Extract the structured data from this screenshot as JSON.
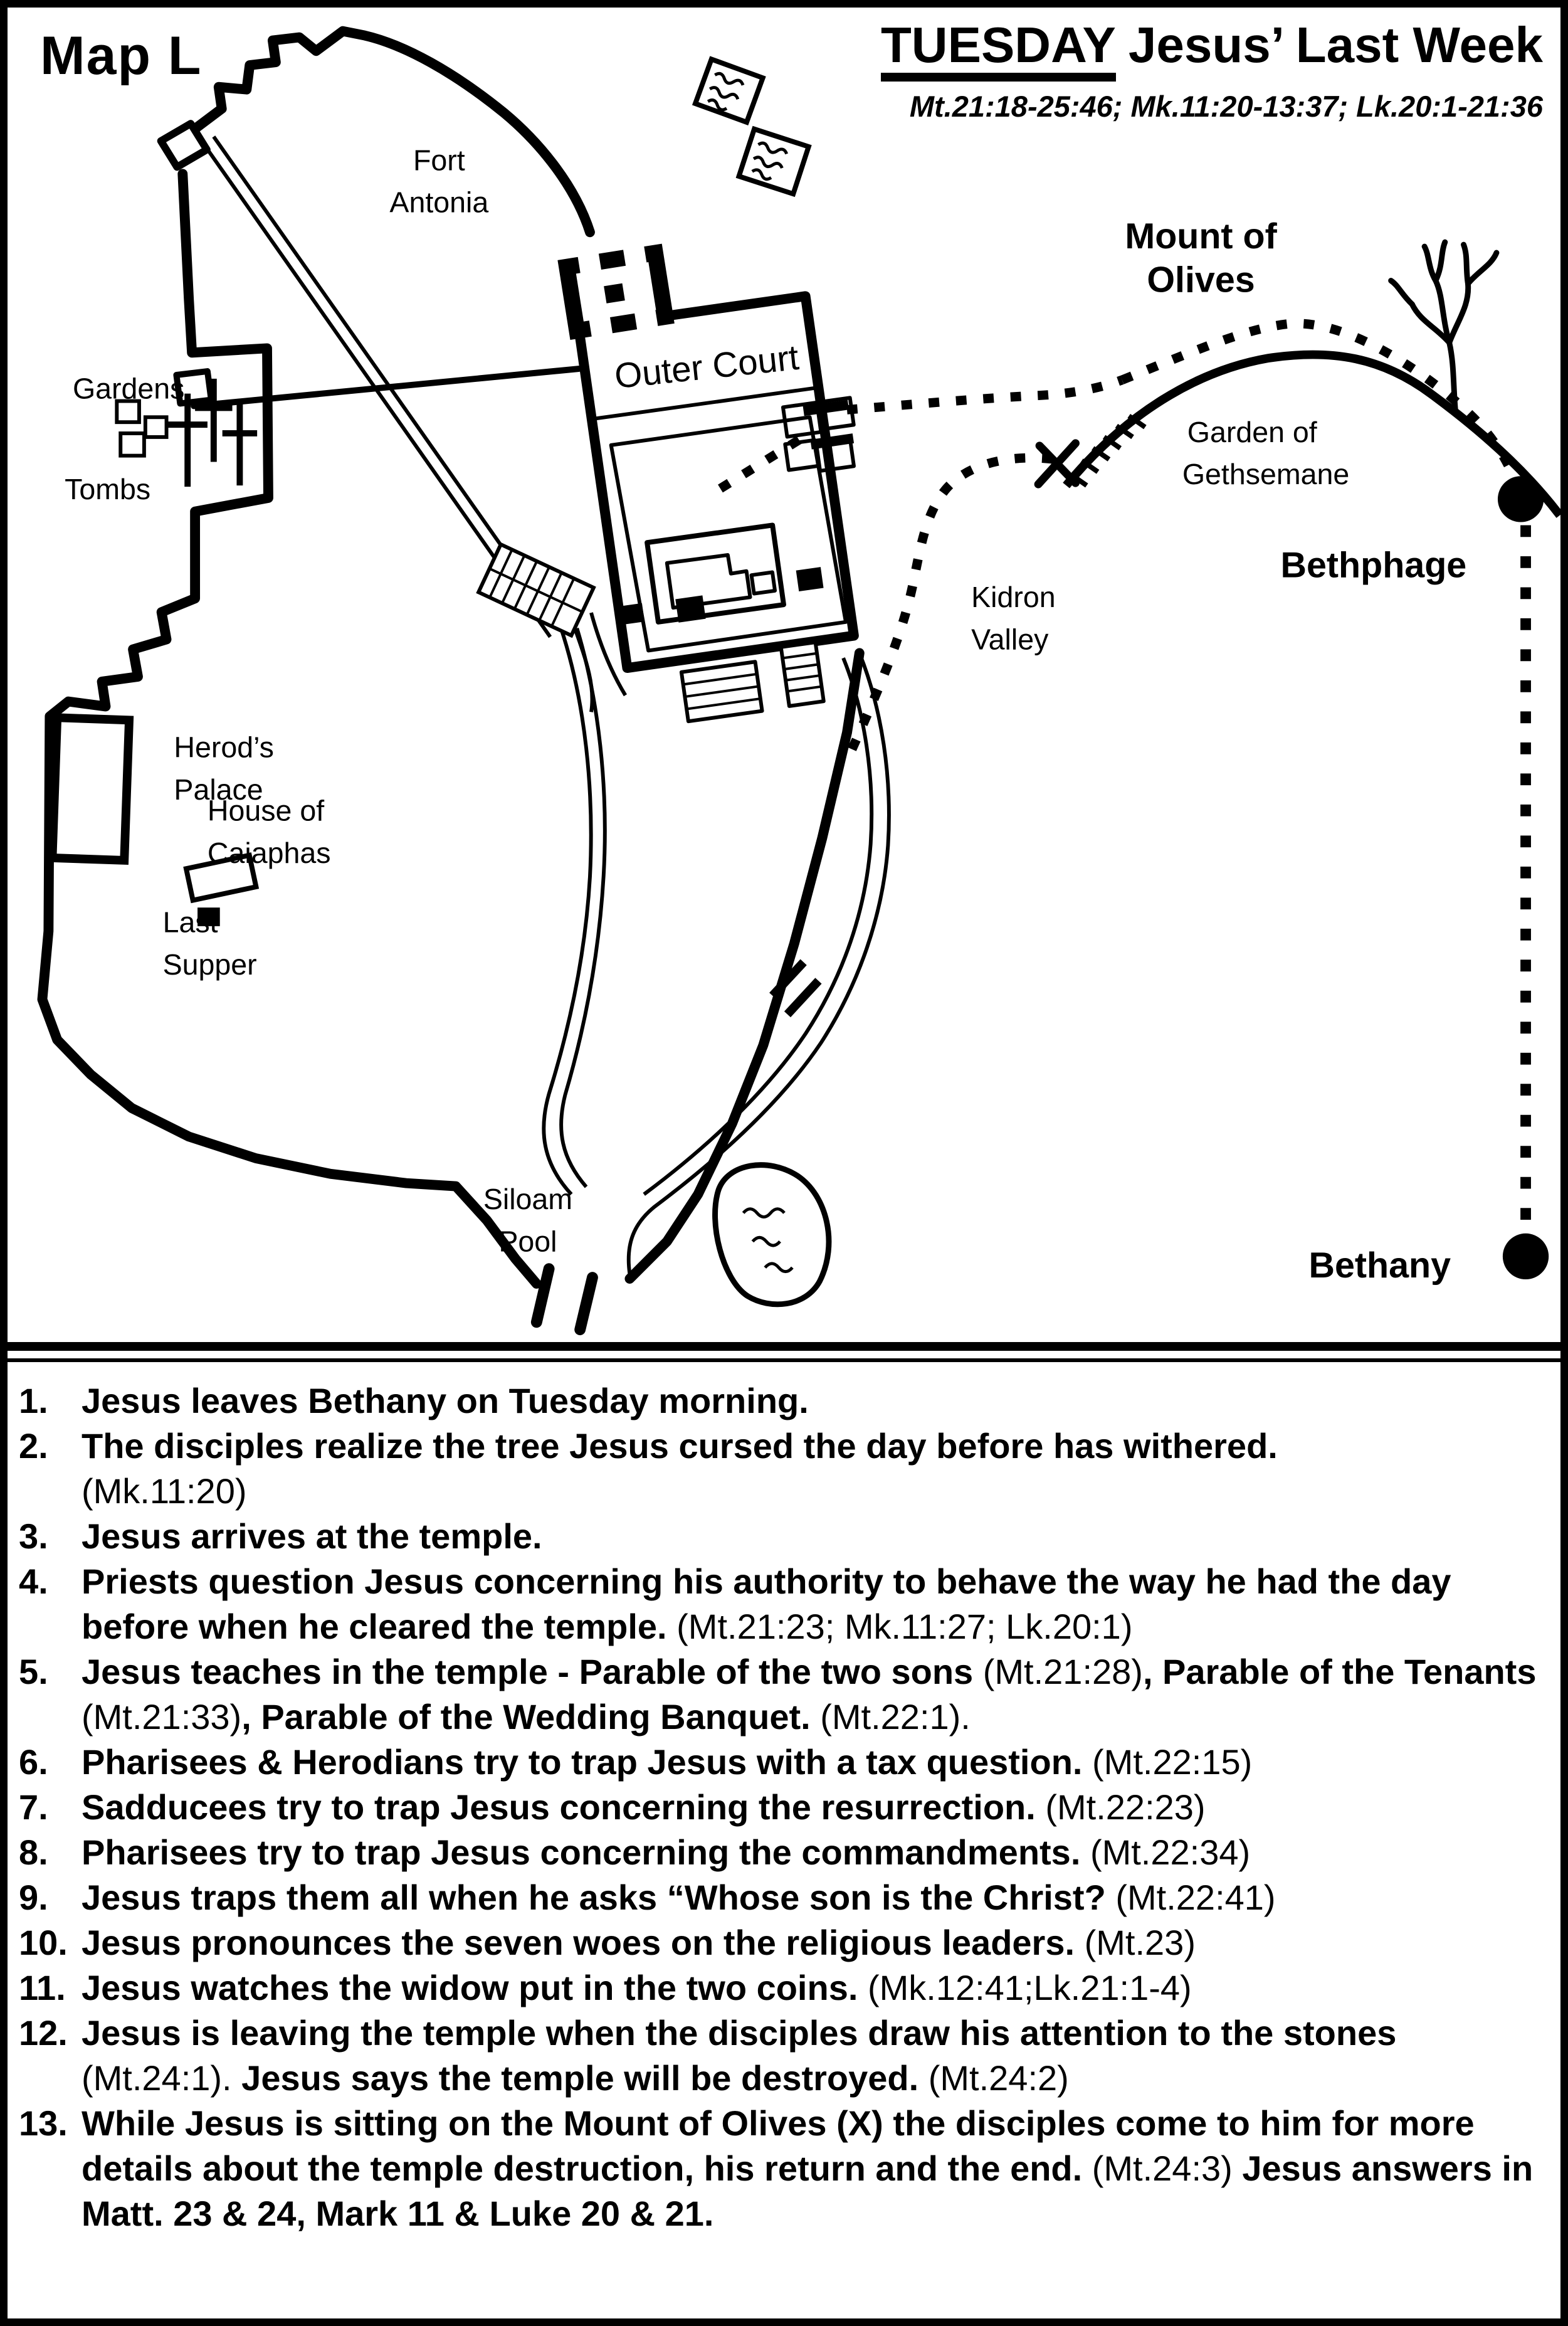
{
  "colors": {
    "ink": "#000000",
    "paper": "#ffffff"
  },
  "title": {
    "day": "TUESDAY",
    "rest": "Jesus’ Last Week",
    "refs": "Mt.21:18-25:46; Mk.11:20-13:37; Lk.20:1-21:36"
  },
  "map": {
    "name": "Map L",
    "labels": {
      "fort_antonia": [
        "Fort",
        "Antonia"
      ],
      "outer_court": "Outer Court",
      "mount_of_olives": [
        "Mount of",
        "Olives"
      ],
      "garden_of_gethsemane": [
        "Garden of",
        "Gethsemane"
      ],
      "bethphage": "Bethphage",
      "bethany": "Bethany",
      "kidron_valley": [
        "Kidron",
        "Valley"
      ],
      "gardens": "Gardens",
      "tombs": "Tombs",
      "herods_palace": [
        "Herod’s",
        "Palace"
      ],
      "house_of_caiaphas": [
        "House of",
        "Caiaphas"
      ],
      "last_supper": [
        "Last",
        "Supper"
      ],
      "siloam_pool": [
        "Siloam",
        "Pool"
      ],
      "x_marker": "X"
    }
  },
  "events": [
    {
      "number": "1.",
      "parts": [
        {
          "text": "Jesus leaves Bethany on Tuesday morning.",
          "bold": true
        }
      ]
    },
    {
      "number": "2.",
      "parts": [
        {
          "text": "The disciples realize the tree Jesus cursed the day before has withered.",
          "bold": true
        },
        {
          "text": "(Mk.11:20)",
          "bold": false,
          "br": true
        }
      ]
    },
    {
      "number": "3.",
      "parts": [
        {
          "text": "Jesus arrives at the temple.",
          "bold": true
        }
      ]
    },
    {
      "number": "4.",
      "parts": [
        {
          "text": "Priests question Jesus concerning his authority to behave the way he had the day before when he cleared the temple. ",
          "bold": true
        },
        {
          "text": "(Mt.21:23; Mk.11:27; Lk.20:1)",
          "bold": false
        }
      ]
    },
    {
      "number": "5.",
      "parts": [
        {
          "text": "Jesus teaches in the temple - Parable of the two sons ",
          "bold": true
        },
        {
          "text": "(Mt.21:28)",
          "bold": false
        },
        {
          "text": ", Parable of the Tenants ",
          "bold": true
        },
        {
          "text": "(Mt.21:33)",
          "bold": false
        },
        {
          "text": ", Parable of the Wedding Banquet. ",
          "bold": true
        },
        {
          "text": "(Mt.22:1).",
          "bold": false
        }
      ]
    },
    {
      "number": "6.",
      "parts": [
        {
          "text": "Pharisees & Herodians try to trap Jesus with a tax question. ",
          "bold": true
        },
        {
          "text": "(Mt.22:15)",
          "bold": false
        }
      ]
    },
    {
      "number": "7.",
      "parts": [
        {
          "text": "Sadducees try to trap Jesus concerning the resurrection. ",
          "bold": true
        },
        {
          "text": "(Mt.22:23)",
          "bold": false
        }
      ]
    },
    {
      "number": "8.",
      "parts": [
        {
          "text": "Pharisees try to trap Jesus concerning the commandments. ",
          "bold": true
        },
        {
          "text": "(Mt.22:34)",
          "bold": false
        }
      ]
    },
    {
      "number": "9.",
      "parts": [
        {
          "text": "Jesus traps them all when he asks “Whose son is the Christ? ",
          "bold": true
        },
        {
          "text": "(Mt.22:41)",
          "bold": false
        }
      ]
    },
    {
      "number": "10.",
      "parts": [
        {
          "text": "Jesus pronounces the seven woes on the religious leaders. ",
          "bold": true
        },
        {
          "text": "(Mt.23)",
          "bold": false
        }
      ]
    },
    {
      "number": "11.",
      "parts": [
        {
          "text": "Jesus watches the widow put in the two coins. ",
          "bold": true
        },
        {
          "text": "(Mk.12:41;Lk.21:1-4)",
          "bold": false
        }
      ]
    },
    {
      "number": "12.",
      "parts": [
        {
          "text": "Jesus is leaving the temple when the disciples draw his attention to the stones ",
          "bold": true
        },
        {
          "text": "(Mt.24:1).",
          "bold": false
        },
        {
          "text": "  Jesus says the temple will be destroyed. ",
          "bold": true
        },
        {
          "text": "(Mt.24:2)",
          "bold": false
        }
      ]
    },
    {
      "number": "13.",
      "parts": [
        {
          "text": "While Jesus is sitting on the Mount of Olives (X) the disciples come to him for more details about the temple destruction, his return and the end. ",
          "bold": true
        },
        {
          "text": "(Mt.24:3)",
          "bold": false
        },
        {
          "text": " Jesus answers in Matt. 23 & 24, Mark 11 & Luke 20 & 21.",
          "bold": true
        }
      ]
    }
  ]
}
